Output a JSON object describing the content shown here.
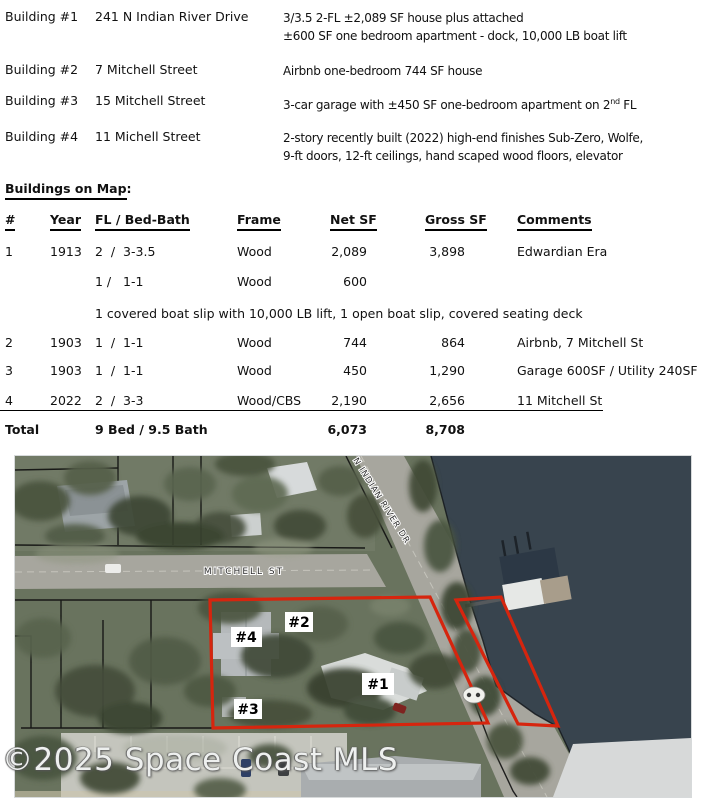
{
  "buildings": {
    "rows": [
      {
        "label": "Building #1",
        "address": "241 N Indian River Drive",
        "line1": "3/3.5 2-FL ±2,089 SF house plus attached",
        "line2": "±600 SF one bedroom apartment - dock, 10,000 LB boat lift"
      },
      {
        "label": "Building #2",
        "address": "7 Mitchell Street",
        "line1": "Airbnb one-bedroom 744 SF house"
      },
      {
        "label": "Building #3",
        "address": "15 Mitchell Street",
        "line1_pre": "3-car garage with ±450 SF one-bedroom apartment on 2",
        "line1_sup": "nd",
        "line1_post": " FL"
      },
      {
        "label": "Building #4",
        "address": "11 Michell Street",
        "line1": "2-story recently built (2022) high-end finishes Sub-Zero, Wolfe,",
        "line2": "9-ft doors, 12-ft ceilings, hand scaped wood floors, elevator"
      }
    ]
  },
  "section": {
    "title": "Buildings on Map",
    "colon": ":"
  },
  "table": {
    "headers": [
      "#",
      "Year",
      "FL / Bed-Bath",
      "Frame",
      "Net SF",
      "Gross SF",
      "Comments"
    ],
    "rows": [
      {
        "num": "1",
        "year": "1913",
        "fbb": "2  /  3-3.5",
        "frame": "Wood",
        "net": "2,089",
        "gross": "3,898",
        "comments": "Edwardian Era"
      },
      {
        "num": "",
        "year": "",
        "fbb": "1 /   1-1",
        "frame": "Wood",
        "net": "600",
        "gross": "",
        "comments": ""
      },
      {
        "num": "2",
        "year": "1903",
        "fbb": "1  /  1-1",
        "frame": "Wood",
        "net": "744",
        "gross": "864",
        "comments": "Airbnb, 7 Mitchell St"
      },
      {
        "num": "3",
        "year": "1903",
        "fbb": "1  /  1-1",
        "frame": "Wood",
        "net": "450",
        "gross": "1,290",
        "comments": "Garage 600SF / Utility 240SF"
      },
      {
        "num": "4",
        "year": "2022",
        "fbb": "2  /  3-3",
        "frame": "Wood/CBS",
        "net": "2,190",
        "gross": "2,656",
        "comments": "11 Mitchell St"
      }
    ],
    "note": "1 covered boat slip with 10,000 LB lift, 1 open boat slip, covered seating deck",
    "total": {
      "label": "Total",
      "bedbath": "9 Bed / 9.5 Bath",
      "net": "6,073",
      "gross": "8,708"
    }
  },
  "map": {
    "streets": {
      "mitchell": "MITCHELL ST",
      "indian_river": "N INDIAN RIVER DR"
    },
    "markers": [
      {
        "id": "#4"
      },
      {
        "id": "#2"
      },
      {
        "id": "#3"
      },
      {
        "id": "#1"
      }
    ],
    "watermark": "©2025 Space Coast MLS",
    "outline_color": "#d6250e",
    "water_color": "#38444e"
  }
}
